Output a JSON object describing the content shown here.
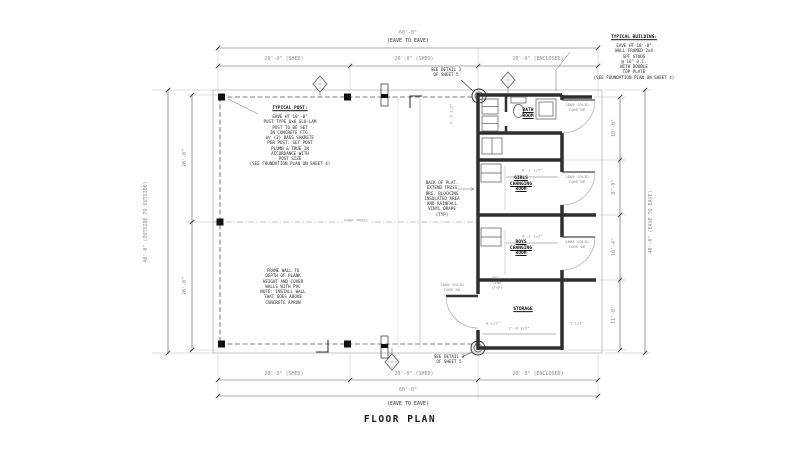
{
  "title": "FLOOR PLAN",
  "dims": {
    "overall": "60'-0\"",
    "overall_note": "(EAVE TO EAVE)",
    "seg_shed": "20'-0\" (SHED)",
    "seg_encl": "20'-0\" (ENCLOSED)",
    "left_overall": "40'-0\" (OUTSIDE TO OUTSIDE)",
    "left_seg": "20'-0\"",
    "right_overall": "40'-0\" (EAVE TO EAVE)",
    "right_segs": [
      "10'-0\"",
      "8'-9\"",
      "10'-4\"",
      "11'-0\""
    ],
    "girls_width": "9'-1 1/2\"",
    "boys_width": "9'-1 1/2\"",
    "storage_width": "7'-0 1/2\"",
    "storage_left": "8 1/2\"",
    "storage_right": "5 1/2\"",
    "bath_width": "4'-0 1/2\""
  },
  "rooms": {
    "bath": "BATH\nROOM",
    "girls": "GIRLS\nCHANGING\nROOM",
    "boys": "BOYS\nCHANGING\nROOM",
    "storage": "STORAGE"
  },
  "notes": {
    "typical_post_title": "TYPICAL POST:",
    "typical_post_body": "EAVE HT 10'-0\"\nPOST TYPE 6x6 GLU-LAM\nPOST TO BE SET\nIN CONCRETE FTG.\nW/ (2) BAGS SAKRETE\nPER POST. SET POST\nPLUMB & TRUE IN\nACCORDANCE WITH\nPOST SIZE\n(SEE FOUNDATION PLAN ON SHEET 4)",
    "typical_building_title": "TYPICAL BUILDING:",
    "typical_building_body": "EAVE HT 10'-0\"\nWALL FRAMED 2x4\nSPF STUDS\n@ 16\" O.C.\nWITH DOUBLE\nTOP PLATE\n(SEE FOUNDATION PLAN ON SHEET 4)",
    "frame_wall": "FRAME WALL TO\nDEPTH OF PLANK\nHEIGHT AND COVER\nWALLS WITH PVC\nNOTE: INSTALL WALL\nTHAT GOES ABOVE\nCONCRETE APRON",
    "platform": "BACK OF PLAT.\nEXTEND TRUSS\nBRG. BLOCKING\nINSULATED AREA\nAND RAINFALL\nVINYL DRAPE\n(TYP)",
    "see_detail": "SEE DETAIL 3\nOF SHEET 5",
    "wall_line": "WALL\nLINE\n(TYP)",
    "roof_truss": "ROOF TRUSS",
    "door_tag": "2868 SOLID\nCORE DR"
  }
}
